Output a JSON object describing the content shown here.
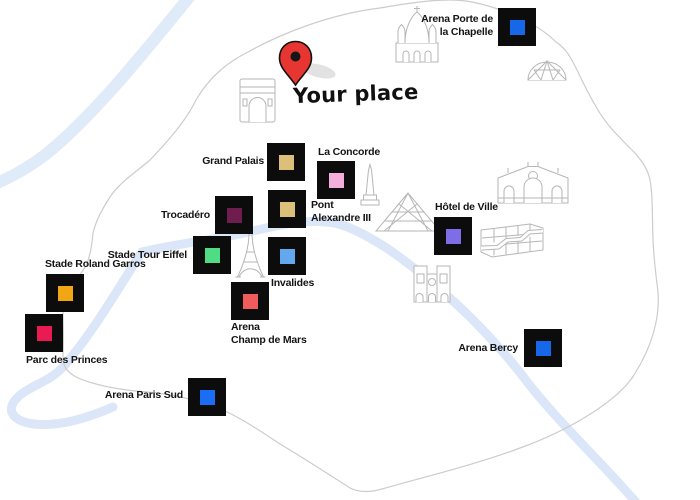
{
  "theme": {
    "boundary": "#cccccc",
    "river": "#dbe7f8",
    "square": "#0c0c0c",
    "pin": "#e73531",
    "icon": "#b6b6b6",
    "label": "#141414"
  },
  "your_place": {
    "label": "Your place",
    "pin_color": "#e73531"
  },
  "venues": [
    {
      "id": "arena-porte-de-la-chapelle",
      "label": "Arena Porte de\nla Chapelle",
      "color": "#1767e9"
    },
    {
      "id": "grand-palais",
      "label": "Grand Palais",
      "color": "#dcc079"
    },
    {
      "id": "la-concorde",
      "label": "La Concorde",
      "color": "#f3aedb"
    },
    {
      "id": "pont-alexandre-iii",
      "label": "Pont\nAlexandre III",
      "color": "#dcc079"
    },
    {
      "id": "trocadero",
      "label": "Trocadéro",
      "color": "#6e1d4e"
    },
    {
      "id": "stade-tour-eiffel",
      "label": "Stade Tour Eiffel",
      "color": "#4fdc85"
    },
    {
      "id": "invalides",
      "label": "Invalides",
      "color": "#63a8ec"
    },
    {
      "id": "arena-champ-de-mars",
      "label": "Arena\nChamp de Mars",
      "color": "#f05c5c"
    },
    {
      "id": "stade-roland-garros",
      "label": "Stade Roland Garros",
      "color": "#f0a713"
    },
    {
      "id": "parc-des-princes",
      "label": "Parc des Princes",
      "color": "#ea1a52"
    },
    {
      "id": "hotel-de-ville",
      "label": "Hôtel de Ville",
      "color": "#7d6ee8"
    },
    {
      "id": "arena-bercy",
      "label": "Arena Bercy",
      "color": "#1767e9"
    },
    {
      "id": "arena-paris-sud",
      "label": "Arena Paris Sud",
      "color": "#1b6ef3"
    }
  ],
  "landmarks": [
    "sacre-coeur",
    "geodesic-dome",
    "arc-de-triomphe",
    "luxor-obelisk",
    "louvre-pyramid",
    "eiffel-tower",
    "notre-dame",
    "grand-station",
    "city-blocks"
  ]
}
